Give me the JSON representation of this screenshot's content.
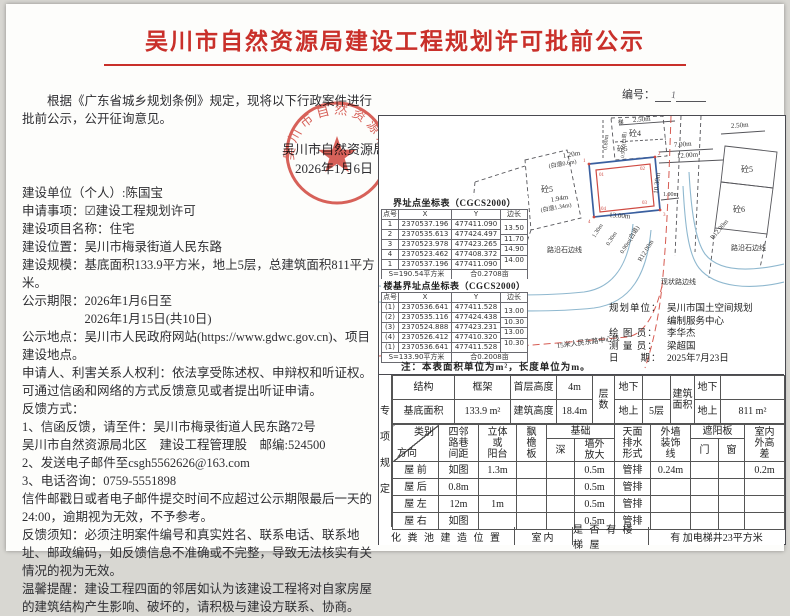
{
  "page": {
    "title": "吴川市自然资源局建设工程规划许可批前公示",
    "no_label": "编号：",
    "no_mark": "1"
  },
  "left": {
    "intro": "根据《广东省城乡规划条例》规定，现将以下行政案件进行批前公示，公开征询意见。",
    "authority": "吴川市自然资源局",
    "authority_date": "2026年1月6日",
    "paragraphs": [
      "建设单位（个人）:陈国宝",
      "申请事项：☑建设工程规划许可",
      "建设项目名称：住宅",
      "建设位置：吴川市梅录街道人民东路",
      "建设规模：基底面积133.9平方米，地上5层，总建筑面积811平方米。",
      "公示期限：2026年1月6日至",
      "2026年1月15日(共10日)",
      "公示地点：吴川市人民政府网站(https://www.gdwc.gov.cn)、项目建设地点。",
      "申请人、利害关系人权利：依法享受陈述权、申辩权和听证权。",
      "可通过信函和网络的方式反馈意见或者提出听证申请。",
      "反馈方式：",
      "1、信函反馈，请至件：吴川市梅录街道人民东路72号",
      "吴川市自然资源局北区　建设工程管理股　邮编:524500",
      "2、发送电子邮件至csgh5562626@163.com",
      "3、电话咨询：0759-5551898",
      "信件邮戳日或者电子邮件提交时间不应超过公示期限最后一天的24:00，逾期视为无效，不予参考。",
      "反馈须知：必须注明案件编号和真实姓名、联系电话、联系地址、邮政编码，如反馈信息不准确或不完整，导致无法核实有关情况的视为无效。",
      "温馨提醒：建设工程四面的邻居如认为该建设工程将对自家房屋的建筑结构产生影响、破坏的，请积极与建设方联系、协商。"
    ]
  },
  "seal": {
    "org": "吴川市自然资源局"
  },
  "map": {
    "b4": "砼4",
    "b5_left": "砼5",
    "b5_top": "砼5",
    "b5_right": "砼5",
    "b6": "砼6",
    "ti": "梯",
    "d250t": "2.50m",
    "d080": "0.80m",
    "d050": "0.50m(白退)",
    "d700": "7.00m",
    "d1200": "12.00m",
    "d250r": "2.50m",
    "d120": "1.20m",
    "d120n": "(白退0.6m)",
    "d194": "1.94m",
    "d194n": "(白退1.34m)",
    "d1300": "13.00m",
    "d1030": "10.30m",
    "d100": "1.00m",
    "d130": "1.30m",
    "d030": "0.30m",
    "d090": "0.90m(白退)",
    "r12a": "R12.00m",
    "r12b": "R12.00m",
    "curb_l": "路沿石边线",
    "road": "现状路边线",
    "curb_r": "路沿石边线",
    "center": "15米人民东路中心线",
    "p1": "1",
    "p2": "2",
    "p3": "3",
    "p4": "4",
    "p01": "01",
    "p02": "02",
    "p03": "03",
    "p04": "04"
  },
  "boundary_table": {
    "title": "界址点坐标表（CGCS2000）",
    "h_id": "点号",
    "h_x": "X",
    "h_y": "Y",
    "h_len": "边长",
    "rows": [
      {
        "id": "1",
        "x": "2370537.196",
        "y": "477411.090",
        "len": ""
      },
      {
        "id": "2",
        "x": "2370535.613",
        "y": "477424.497",
        "len": "13.50"
      },
      {
        "id": "3",
        "x": "2370523.978",
        "y": "477423.265",
        "len": "11.70"
      },
      {
        "id": "4",
        "x": "2370523.462",
        "y": "477408.372",
        "len": "14.90"
      },
      {
        "id": "1",
        "x": "2370537.196",
        "y": "477411.090",
        "len": "14.00"
      }
    ],
    "area": "S=190.54平方米",
    "area_mu": "合0.2708亩"
  },
  "foundation_table": {
    "title": "楼基界址点坐标表（CGCS2000）",
    "h_id": "点号",
    "h_x": "X",
    "h_y": "Y",
    "h_len": "边长",
    "rows": [
      {
        "id": "(1)",
        "x": "2370536.641",
        "y": "477411.528",
        "len": ""
      },
      {
        "id": "(2)",
        "x": "2370535.116",
        "y": "477424.438",
        "len": "13.00"
      },
      {
        "id": "(3)",
        "x": "2370524.888",
        "y": "477423.231",
        "len": "10.30"
      },
      {
        "id": "(4)",
        "x": "2370526.412",
        "y": "477410.320",
        "len": "13.00"
      },
      {
        "id": "(1)",
        "x": "2370536.641",
        "y": "477411.528",
        "len": "10.30"
      }
    ],
    "area": "S=133.90平方米",
    "area_mu": "合0.2008亩"
  },
  "note": "注：本表面积单位为m²，长度单位为m。",
  "info": {
    "rows": [
      {
        "label": "规划单位：",
        "value": "吴川市国土空间规划"
      },
      {
        "label": "",
        "value": "编制服务中心"
      },
      {
        "label": "绘 图 员：",
        "value": "李华杰"
      },
      {
        "label": "测 量 员：",
        "value": "梁超国"
      },
      {
        "label": "日　　期：",
        "value": "2025年7月23日"
      }
    ]
  },
  "spec": {
    "side_label": "专\n项\n规\n定",
    "structure_label": "结构",
    "structure": "框架",
    "first_floor_label": "首层高度",
    "first_floor": "4m",
    "floors_label": "层\n数",
    "base_label": "基底面积",
    "base": "133.9 m²",
    "height_label": "建筑高度",
    "height": "18.4m",
    "below1_label": "地下",
    "below1": "",
    "above1_label": "地上",
    "above1": "5层",
    "area_label": "建筑\n面积",
    "below2_label": "地下",
    "below2": "",
    "above2_label": "地上",
    "above2": "811  m²",
    "hdr": {
      "cat": "类别",
      "dir": "方向",
      "dist": "四邻\n路巷\n间距",
      "balcony": "立体\n或\n阳台",
      "eave": "飘\n檐\n板",
      "foundation": "基础",
      "depth": "深",
      "expand": "墙外\n放大",
      "drain": "天面\n排水\n形式",
      "deco": "外墙\n装饰\n线",
      "sunshade": "遮阳板",
      "door": "门",
      "window": "窗",
      "hdiff": "室内\n外高\n差"
    },
    "rows": [
      {
        "dir": "屋 前",
        "dist": "如图",
        "balcony": "1.3m",
        "eave": "",
        "depth": "",
        "expand": "0.5m",
        "drain": "管排",
        "deco": "0.24m",
        "door": "",
        "window": "",
        "hdiff": "0.2m"
      },
      {
        "dir": "屋 后",
        "dist": "0.8m",
        "balcony": "",
        "eave": "",
        "depth": "",
        "expand": "0.5m",
        "drain": "管排",
        "deco": "",
        "door": "",
        "window": "",
        "hdiff": ""
      },
      {
        "dir": "屋 左",
        "dist": "12m",
        "balcony": "1m",
        "eave": "",
        "depth": "",
        "expand": "0.5m",
        "drain": "管排",
        "deco": "",
        "door": "",
        "window": "",
        "hdiff": ""
      },
      {
        "dir": "屋 右",
        "dist": "如图",
        "balcony": "",
        "eave": "",
        "depth": "",
        "expand": "0.5m",
        "drain": "管排",
        "deco": "",
        "door": "",
        "window": "",
        "hdiff": ""
      }
    ],
    "septic_label": "化 粪 池 建 造 位 置",
    "septic_value": "室内",
    "stairs_label": "是 否 有 楼 梯 屋",
    "stairs_value": "有  加电梯井23平方米"
  }
}
